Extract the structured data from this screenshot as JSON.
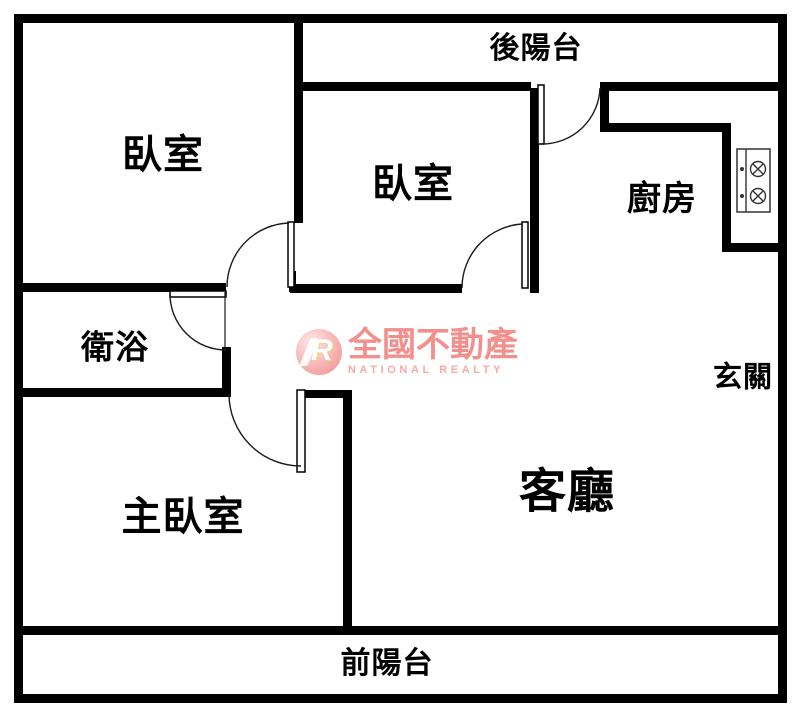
{
  "rooms": {
    "bedroom1": {
      "label": "臥室"
    },
    "bedroom2": {
      "label": "臥室"
    },
    "back_balcony": {
      "label": "後陽台"
    },
    "kitchen": {
      "label": "廚房"
    },
    "bathroom": {
      "label": "衛浴"
    },
    "entryway": {
      "label": "玄關"
    },
    "master_bedroom": {
      "label": "主臥室"
    },
    "living_room": {
      "label": "客廳"
    },
    "front_balcony": {
      "label": "前陽台"
    }
  },
  "watermark": {
    "logo_letter": "R",
    "brand": "全國不動產",
    "sub": "NATIONAL REALTY"
  },
  "colors": {
    "wall": "#000000",
    "background": "#ffffff",
    "watermark_pink": "#f1908c",
    "watermark_pink_light": "#f6aba6"
  },
  "icons": {
    "stove": "stove-two-burner-icon"
  }
}
